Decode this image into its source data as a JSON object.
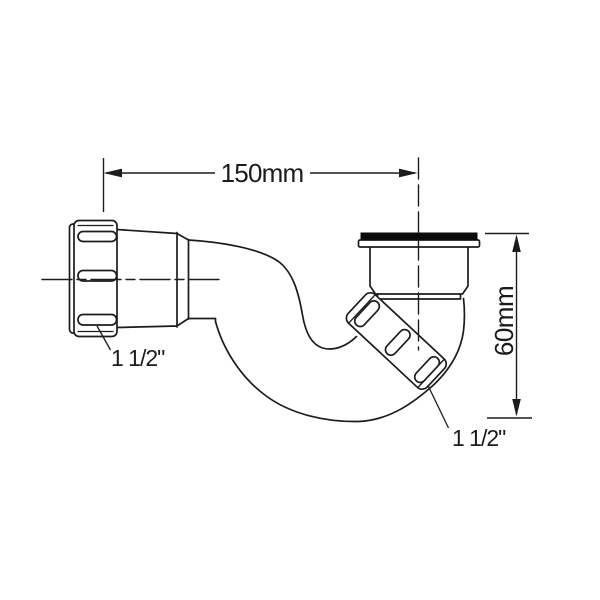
{
  "diagram": {
    "dim_width": {
      "label": "150mm"
    },
    "dim_height": {
      "label": "60mm"
    },
    "callout_left": {
      "label": "1 1/2\""
    },
    "callout_right": {
      "label": "1 1/2\""
    },
    "colors": {
      "line": "#1c1c1c",
      "background": "#ffffff",
      "gasket": "#0a0a0a"
    }
  }
}
